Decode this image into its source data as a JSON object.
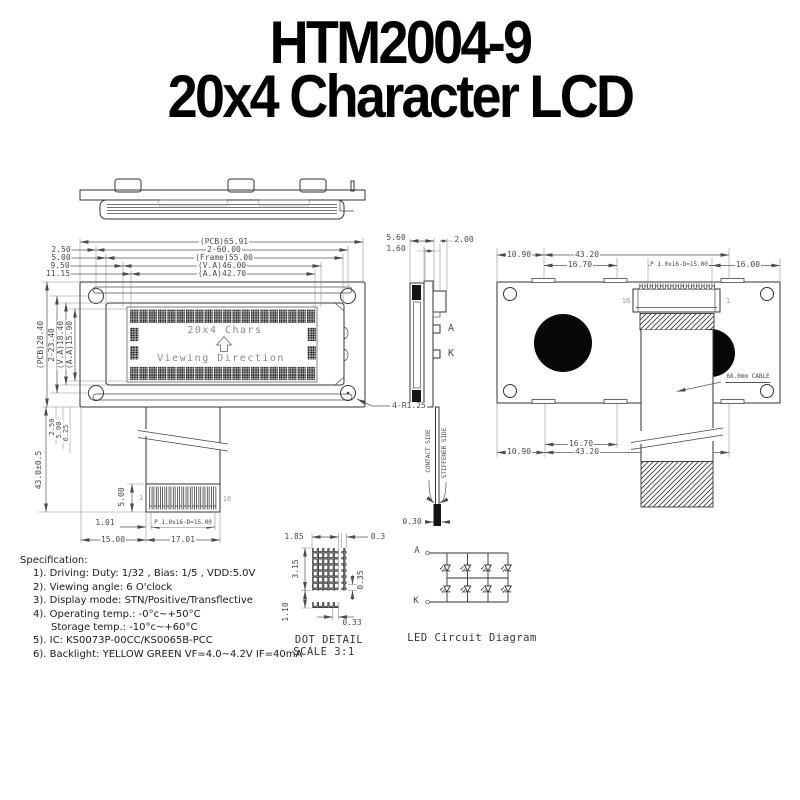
{
  "title": {
    "line1": "HTM2004-9",
    "line2": "20x4 Character LCD"
  },
  "front": {
    "display_label": "20x4 Chars",
    "viewing_label": "Viewing Direction",
    "dims_top": [
      "(PCB)65.91",
      "2-60.00",
      "(Frame)55.00",
      "(V.A)46.00",
      "(A.A)42.70"
    ],
    "dims_top_left": [
      "2.50",
      "5.00",
      "9.50",
      "11.15"
    ],
    "dims_left": [
      "(PCB)28.40",
      "2-23.40",
      "(V.A)18.40",
      "(A.A)15.90"
    ],
    "dims_bottom_left": [
      "2.50",
      "5.00",
      "6.25"
    ],
    "overall_height": "43.0±0.5",
    "corner_note": "4-R1.25",
    "connector": {
      "height": "5.00",
      "offset": "1.01",
      "pitch": "P 1.0x16-D=15.00",
      "left": "15.00",
      "width": "17.01",
      "pin_first": "1",
      "pin_last": "16"
    }
  },
  "side": {
    "dims_top": [
      "5.60",
      "1.60",
      "2.00"
    ],
    "anode": "A",
    "cathode": "K",
    "contact": "CONTACT SIDE",
    "stiffener": "STIFFENER SIDE",
    "tip": "0.30"
  },
  "rear": {
    "dims_top": [
      "10.90",
      "43.20",
      "16.70",
      "P 1.0x16-D=15.00",
      "16.00"
    ],
    "dims_bottom": [
      "16.70",
      "10.90",
      "43.20"
    ],
    "pin_left": "16",
    "pin_right": "1",
    "cable_note": "68.0mm CABLE"
  },
  "dot": {
    "width": "1.85",
    "gap": "0.3",
    "height": "3.15",
    "dot_h": "0.35",
    "row_gap": "1.10",
    "dot_w": "0.33",
    "caption": "DOT DETAIL",
    "scale": "SCALE 3:1"
  },
  "led": {
    "anode": "A",
    "cathode": "K",
    "caption": "LED Circuit Diagram"
  },
  "spec": {
    "heading": "Specification:",
    "items": [
      "1). Driving: Duty: 1/32 , Bias: 1/5 , VDD:5.0V",
      "2). Viewing angle: 6 O'clock",
      "3). Display mode: STN/Positive/Transflective",
      "4). Operating temp.: -0°c~+50°C",
      "Storage temp.: -10°c~+60°C",
      "5). IC: KS0073P-00CC/KS0065B-PCC",
      "6). Backlight: YELLOW GREEN VF=4.0~4.2V IF=40mA"
    ]
  }
}
